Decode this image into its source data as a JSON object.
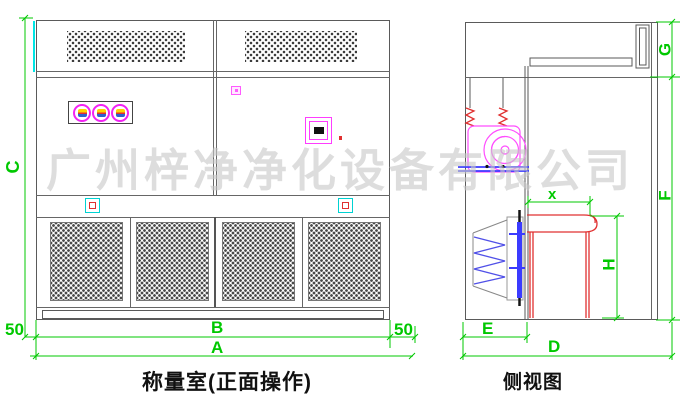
{
  "watermark": {
    "text": "广州梓净净化设备有限公司"
  },
  "front_view": {
    "title": "称量室(正面操作)",
    "dim_height": "C",
    "dim_margin_left": "50",
    "dim_margin_right": "50",
    "dim_width_inner": "B",
    "dim_width_overall": "A"
  },
  "side_view": {
    "title": "侧视图",
    "dim_top_section": "G",
    "dim_body_height": "F",
    "dim_worktop_offset": "x",
    "dim_table_height": "H",
    "dim_rear_depth": "E",
    "dim_overall_depth": "D"
  },
  "colors": {
    "dimension_green": "#00c800",
    "drawing_line": "#5a5a5a",
    "accent_magenta": "#ff4dff",
    "accent_red": "#e03030",
    "accent_blue": "#3b3bff",
    "accent_cyan": "#00d2d2"
  }
}
